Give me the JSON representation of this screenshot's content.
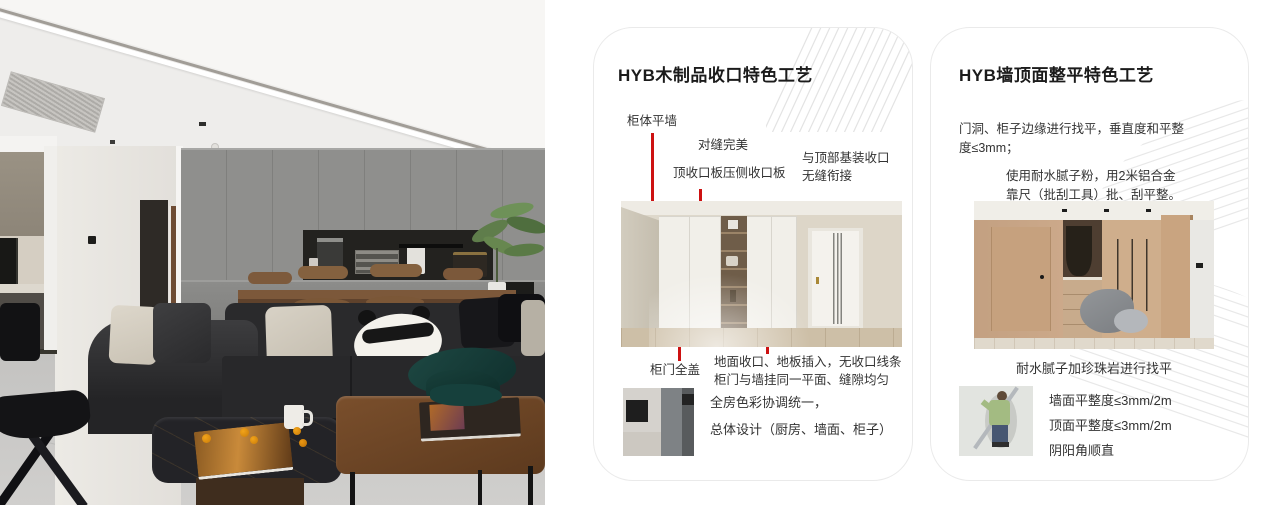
{
  "colors": {
    "accent_red": "#cd1111",
    "card_border": "#eaeaea",
    "title_text": "#1b1b1b",
    "body_text": "#333333"
  },
  "card1": {
    "title": "HYB木制品收口特色工艺",
    "callout_cabinet_wall": "柜体平墙",
    "callout_seam": "对缝完美",
    "callout_top_board": "顶收口板压侧收口板",
    "callout_top_joint_line1": "与顶部基装收口",
    "callout_top_joint_line2": "无缝衔接",
    "callout_full_cover": "柜门全盖",
    "note_line1": "地面收口、地板插入，无收口线条",
    "note_line2": "柜门与墙挂同一平面、缝隙均匀",
    "summary_line1": "全房色彩协调统一，",
    "summary_line2": "总体设计（厨房、墙面、柜子）"
  },
  "card2": {
    "title": "HYB墙顶面整平特色工艺",
    "para1_line1": "门洞、柜子边缘进行找平，垂直度和平整",
    "para1_line2": "度≤3mm；",
    "para2_line1": "使用耐水腻子粉，用2米铝合金",
    "para2_line2": "靠尺（批刮工具）批、刮平整。",
    "caption": "耐水腻子加珍珠岩进行找平",
    "spec_line1": "墙面平整度≤3mm/2m",
    "spec_line2": "顶面平整度≤3mm/2m",
    "spec_line3": "阴阳角顺直"
  }
}
